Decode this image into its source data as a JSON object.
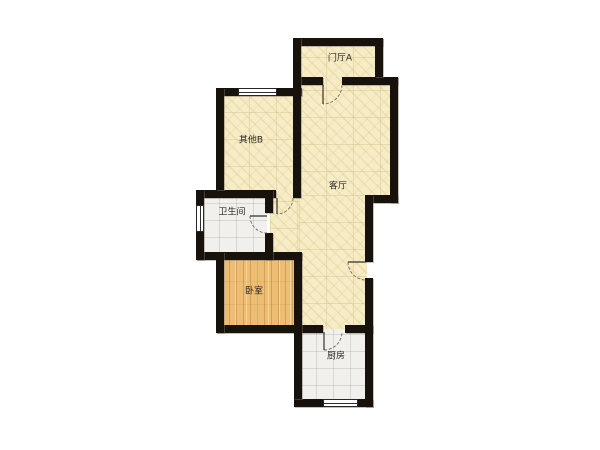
{
  "plan": {
    "type": "apartment-floor-plan",
    "rooms": [
      {
        "id": "entry-hall",
        "label": "门厅A",
        "floor": "beige"
      },
      {
        "id": "other-b",
        "label": "其他B",
        "floor": "beige"
      },
      {
        "id": "living-room",
        "label": "客厅",
        "floor": "beige"
      },
      {
        "id": "bathroom",
        "label": "卫生间",
        "floor": "tile"
      },
      {
        "id": "bedroom",
        "label": "卧室",
        "floor": "wood"
      },
      {
        "id": "kitchen",
        "label": "厨房",
        "floor": "tile"
      }
    ],
    "colors": {
      "wall": "#17130c",
      "floor_beige": "#f6ecc6",
      "floor_wood": "#ecbd72",
      "floor_tile": "#f1f0ec",
      "background": "#ffffff",
      "door_line": "#6f6a60"
    }
  }
}
